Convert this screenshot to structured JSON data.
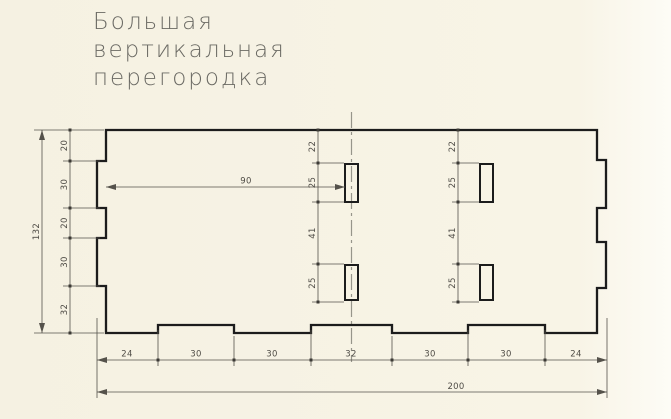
{
  "title": {
    "lines": [
      "Большая",
      "вертикальная",
      "перегородка"
    ]
  },
  "dimensions": {
    "overall_height": "132",
    "overall_width": "200",
    "left_chain": [
      "20",
      "30",
      "20",
      "30",
      "32"
    ],
    "middle_slot_chain": [
      "22",
      "25",
      "41",
      "25"
    ],
    "right_slot_chain": [
      "22",
      "25",
      "41",
      "25"
    ],
    "slot_offset": "90",
    "bottom_chain": [
      "24",
      "30",
      "30",
      "32",
      "30",
      "30",
      "24"
    ]
  },
  "colors": {
    "background": "#f8f4e6",
    "outline": "#1c1c1c",
    "dimension": "#55524b",
    "centerline": "#97958a",
    "title_text": "#6b6a64"
  }
}
